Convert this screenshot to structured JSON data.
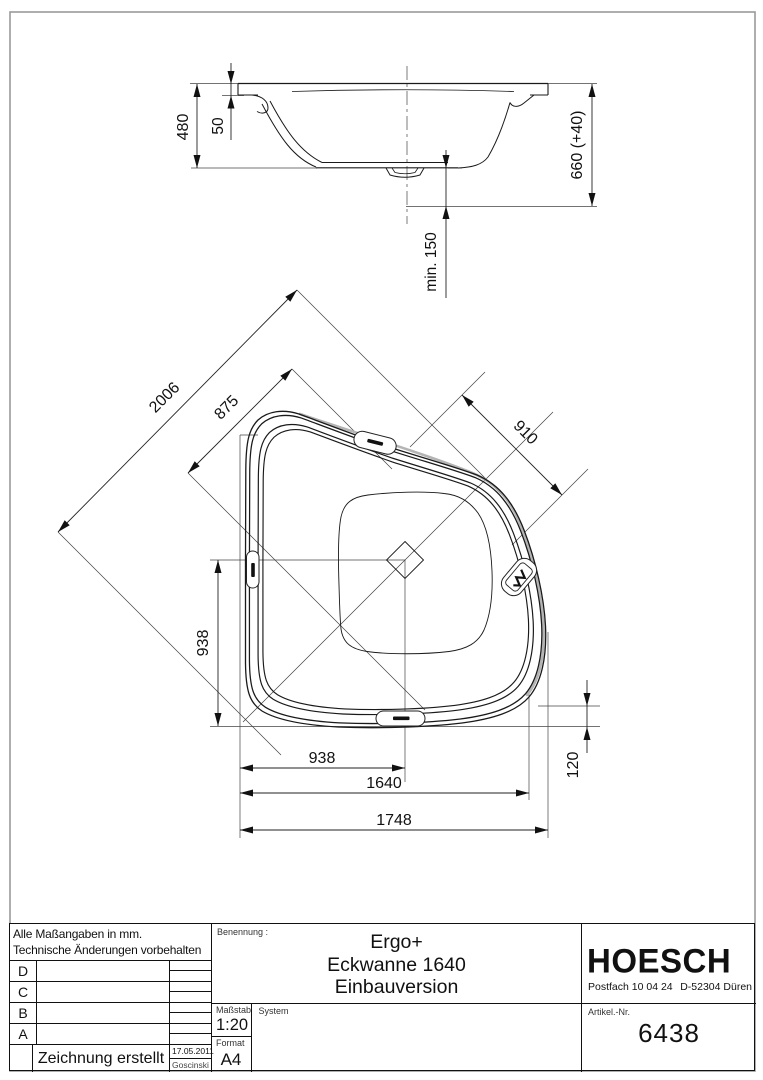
{
  "colors": {
    "line": "#1a1a1a",
    "frame": "#9a9a9a",
    "shading": "#b4b4b4"
  },
  "drawing": {
    "side_view": {
      "dim_480": "480",
      "dim_50": "50",
      "dim_660": "660 (+40)",
      "dim_min150": "min. 150"
    },
    "plan_view": {
      "dim_2006": "2006",
      "dim_875": "875",
      "dim_910": "910",
      "dim_938_vertical": "938",
      "dim_938_horizontal": "938",
      "dim_1640": "1640",
      "dim_1748": "1748",
      "dim_120": "120"
    }
  },
  "title_block": {
    "note_line1": "Alle Maßangaben in mm.",
    "note_line2": "Technische Änderungen vorbehalten",
    "revision_rows": [
      "D",
      "C",
      "B",
      "A"
    ],
    "created_label": "Zeichnung erstellt",
    "created_date": "17.05.2011",
    "created_by": "Goscinski",
    "name_label": "Benennung :",
    "product_line1": "Ergo+",
    "product_line2": "Eckwanne 1640",
    "product_line3": "Einbauversion",
    "scale_label": "Maßstab",
    "scale_value": "1:20",
    "system_label": "System",
    "format_label": "Format",
    "format_value": "A4",
    "brand": "HOESCH",
    "address_left": "Postfach 10 04 24",
    "address_right": "D-52304 Düren",
    "article_label": "Artikel.-Nr.",
    "article_value": "6438"
  }
}
